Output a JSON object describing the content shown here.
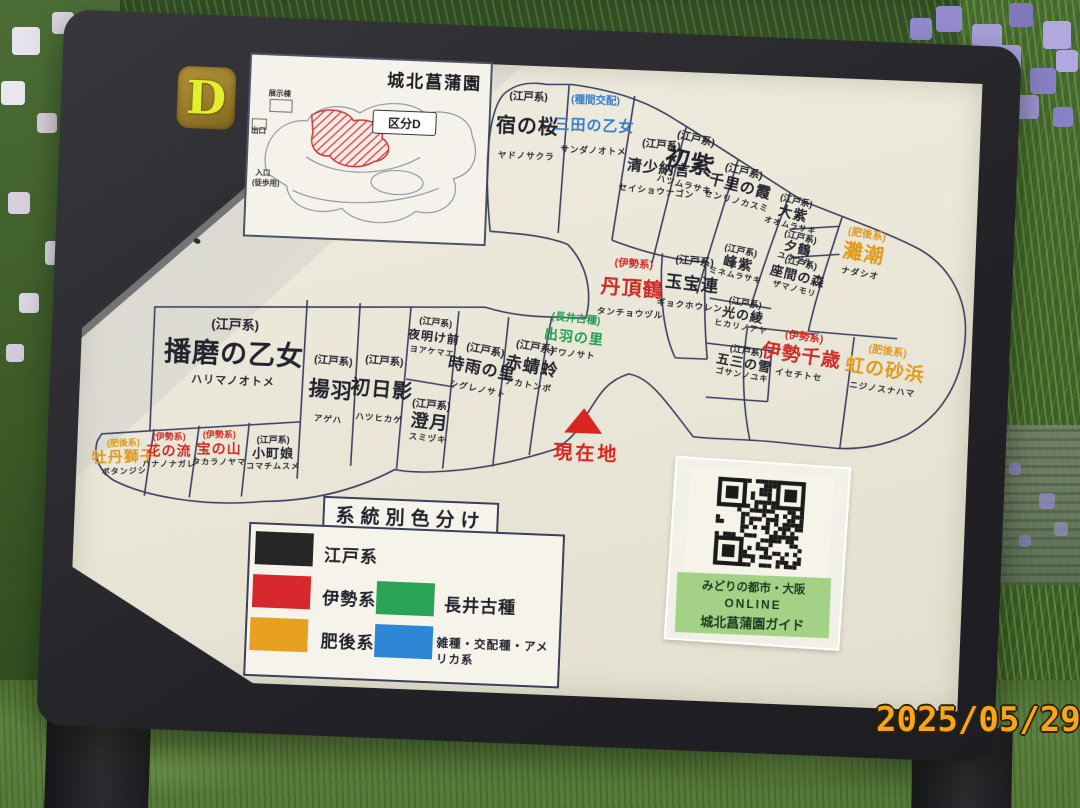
{
  "photo": {
    "date_stamp": "2025/05/29"
  },
  "sign": {
    "section_badge": "D",
    "mini_map": {
      "title": "城北菖蒲園",
      "callout": "区分D",
      "labels": {
        "exhibit_hall": "展示棟",
        "exit": "出口",
        "entrance": "入口",
        "entrance_note": "(徒歩用)"
      }
    },
    "current_location_label": "現在地",
    "plots": [
      {
        "category": "(江戸系)",
        "name": "宿の桜",
        "kana": "ヤドノサクラ",
        "lineage": "edo"
      },
      {
        "category": "(種間交配)",
        "name": "三田の乙女",
        "kana": "サンダノオトメ",
        "lineage": "cross"
      },
      {
        "category": "(江戸系)",
        "name": "清少納言",
        "kana": "セイショウナゴン",
        "lineage": "edo"
      },
      {
        "category": "(江戸系)",
        "name": "初紫",
        "kana": "ハツムラサキ",
        "lineage": "edo"
      },
      {
        "category": "(江戸系)",
        "name": "千里の霞",
        "kana": "センリノカスミ",
        "lineage": "edo"
      },
      {
        "category": "(江戸系)",
        "name": "大紫",
        "kana": "オオムラサキ",
        "lineage": "edo"
      },
      {
        "category": "(江戸系)",
        "name": "夕鶴",
        "kana": "ユウヅル",
        "lineage": "edo"
      },
      {
        "category": "(江戸系)",
        "name": "座間の森",
        "kana": "ザマノモリ",
        "lineage": "edo"
      },
      {
        "category": "(肥後系)",
        "name": "灘潮",
        "kana": "ナダシオ",
        "lineage": "higo"
      },
      {
        "category": "(江戸系)",
        "name": "峰紫",
        "kana": "ミネムラサキ",
        "lineage": "edo"
      },
      {
        "category": "(江戸系)",
        "name": "玉宝連",
        "kana": "ギョクホウレン",
        "lineage": "edo"
      },
      {
        "category": "(伊勢系)",
        "name": "丹頂鶴",
        "kana": "タンチョウヅル",
        "lineage": "ise"
      },
      {
        "category": "(江戸系)",
        "name": "光の綾",
        "kana": "ヒカリノアヤ",
        "lineage": "edo"
      },
      {
        "category": "(江戸系)",
        "name": "五三の雪",
        "kana": "ゴサンノユキ",
        "lineage": "edo"
      },
      {
        "category": "(伊勢系)",
        "name": "伊勢千歳",
        "kana": "イセチトセ",
        "lineage": "ise"
      },
      {
        "category": "(肥後系)",
        "name": "虹の砂浜",
        "kana": "ニジノスナハマ",
        "lineage": "higo"
      },
      {
        "category": "(長井古種)",
        "name": "出羽の里",
        "kana": "デワノサト",
        "lineage": "nagai"
      },
      {
        "category": "(江戸系)",
        "name": "赤蜻蛉",
        "kana": "アカトンボ",
        "lineage": "edo"
      },
      {
        "category": "(江戸系)",
        "name": "時雨の里",
        "kana": "シグレノサト",
        "lineage": "edo"
      },
      {
        "category": "(江戸系)",
        "name": "夜明け前",
        "kana": "ヨアケマエ",
        "lineage": "edo"
      },
      {
        "category": "(江戸系)",
        "name": "澄月",
        "kana": "スミヅキ",
        "lineage": "edo"
      },
      {
        "category": "(江戸系)",
        "name": "播磨の乙女",
        "kana": "ハリマノオトメ",
        "lineage": "edo"
      },
      {
        "category": "(江戸系)",
        "name": "揚羽",
        "kana": "アゲハ",
        "lineage": "edo"
      },
      {
        "category": "(江戸系)",
        "name": "初日影",
        "kana": "ハツヒカゲ",
        "lineage": "edo"
      },
      {
        "category": "(肥後系)",
        "name": "牡丹獅子",
        "kana": "ボタンジシ",
        "lineage": "higo"
      },
      {
        "category": "(伊勢系)",
        "name": "花の流",
        "kana": "ハナノナガレ",
        "lineage": "ise"
      },
      {
        "category": "(伊勢系)",
        "name": "宝の山",
        "kana": "タカラノヤマ",
        "lineage": "ise"
      },
      {
        "category": "(江戸系)",
        "name": "小町娘",
        "kana": "コマチムスメ",
        "lineage": "edo"
      }
    ],
    "legend": {
      "title": "系統別色分け",
      "items": [
        {
          "label": "江戸系",
          "color": "#262626"
        },
        {
          "label": "伊勢系",
          "color": "#d7282d"
        },
        {
          "label": "長井古種",
          "color": "#2aa356"
        },
        {
          "label": "肥後系",
          "color": "#e8a020"
        },
        {
          "label": "雑種・交配種・アメリカ系",
          "color": "#2e86d4"
        }
      ]
    },
    "qr": {
      "line1": "みどりの都市・大阪",
      "line2": "ONLINE",
      "line3": "城北菖蒲園ガイド"
    }
  }
}
